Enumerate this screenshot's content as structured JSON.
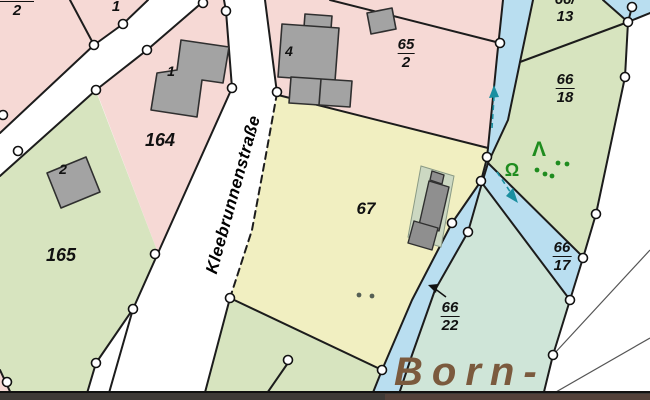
{
  "canvas": {
    "width": 650,
    "height": 400
  },
  "street": {
    "name": "Kleebrunnenstraße"
  },
  "area_name": "Born-",
  "parcels": {
    "tl": {
      "num": "",
      "den": "2"
    },
    "small1": {
      "label": "1"
    },
    "p164": {
      "label": "164"
    },
    "p165": {
      "label": "165"
    },
    "p67": {
      "label": "67"
    },
    "p65_2": {
      "num": "65",
      "den": "2"
    },
    "p66_13": {
      "num": "66/",
      "den": "13"
    },
    "p66_18": {
      "num": "66",
      "den": "18"
    },
    "p66_17": {
      "num": "66",
      "den": "17"
    },
    "p66_22": {
      "num": "66",
      "den": "22"
    }
  },
  "buildings": {
    "b164": "1",
    "b165": "2",
    "b65": "4"
  },
  "symbols": {
    "deciduous_tree": "Ω",
    "conifer_tree": "Λ"
  },
  "colors": {
    "parcel_pink": "#f6d9d5",
    "parcel_green": "#d7e4bf",
    "parcel_yellow": "#f1efc1",
    "parcel_teal": "#cfe5d8",
    "water_blue": "#b9def0",
    "road_white": "#ffffff",
    "building_gray": "#a3a3a3",
    "building_dark": "#8f8f8f",
    "pad_green": "#ccd8c2",
    "boundary": "#1c1c1c",
    "thin_line": "#555555",
    "tree_green": "#1f8c1f",
    "dot_dark": "#566055",
    "flow_teal": "#1a8fa0",
    "strip_dark": "#3e3a37",
    "strip_brown": "#53413a",
    "area_brown": "#7b5a3e"
  }
}
